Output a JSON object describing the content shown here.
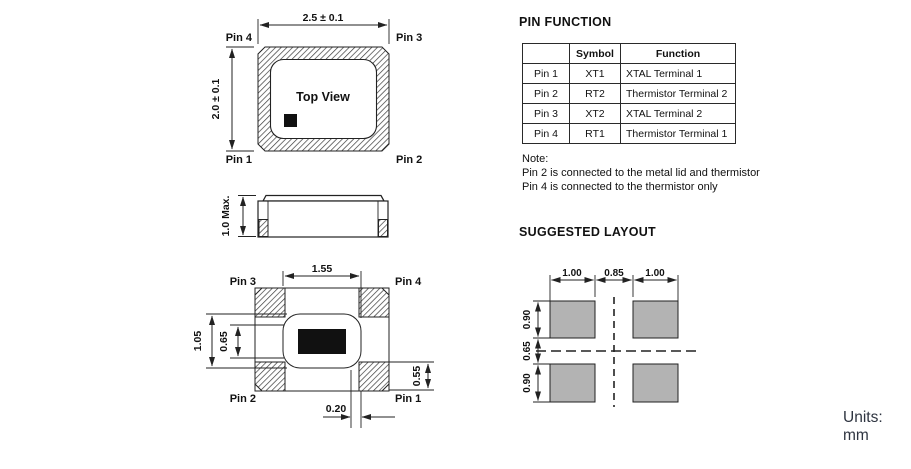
{
  "units_label": "Units: mm",
  "colors": {
    "line": "#222222",
    "pad_fill": "#b3b3b3",
    "marker_fill": "#111111",
    "units_text": "#2e3440"
  },
  "top_view": {
    "label": "Top View",
    "dim_width": "2.5 ± 0.1",
    "dim_height": "2.0 ± 0.1",
    "pin_top_left": "Pin 4",
    "pin_top_right": "Pin 3",
    "pin_bottom_left": "Pin 1",
    "pin_bottom_right": "Pin 2"
  },
  "side_view": {
    "dim_height": "1.0 Max."
  },
  "bottom_view": {
    "dim_width": "1.55",
    "dim_left_outer": "1.05",
    "dim_left_inner": "0.65",
    "dim_pad_height": "0.55",
    "dim_offset": "0.20",
    "pin_top_left": "Pin 3",
    "pin_top_right": "Pin 4",
    "pin_bottom_left": "Pin 2",
    "pin_bottom_right": "Pin 1"
  },
  "pin_function": {
    "title": "PIN FUNCTION",
    "table": {
      "headers": [
        "",
        "Symbol",
        "Function"
      ],
      "rows": [
        [
          "Pin 1",
          "XT1",
          "XTAL Terminal 1"
        ],
        [
          "Pin 2",
          "RT2",
          "Thermistor Terminal 2"
        ],
        [
          "Pin 3",
          "XT2",
          "XTAL Terminal 2"
        ],
        [
          "Pin 4",
          "RT1",
          "Thermistor Terminal 1"
        ]
      ]
    },
    "note": {
      "label": "Note:",
      "line1": "Pin 2 is connected to the metal lid and thermistor",
      "line2": "Pin 4 is connected to the thermistor only"
    }
  },
  "suggested_layout": {
    "title": "SUGGESTED LAYOUT",
    "dim_top_left": "1.00",
    "dim_top_center": "0.85",
    "dim_top_right": "1.00",
    "dim_side_top": "0.90",
    "dim_side_center": "0.65",
    "dim_side_bottom": "0.90"
  }
}
